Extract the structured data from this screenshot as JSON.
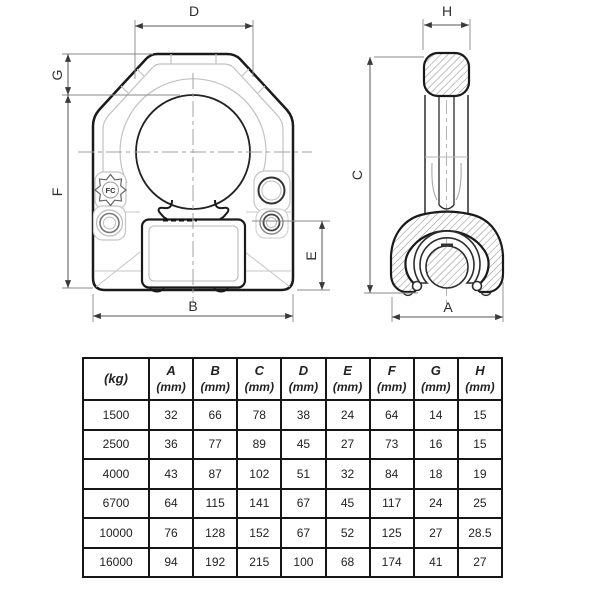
{
  "drawing": {
    "front_view": {
      "dim_labels": {
        "D": "D",
        "G": "G",
        "F": "F",
        "B": "B",
        "E": "E"
      },
      "logo_text": "FC"
    },
    "side_view": {
      "dim_labels": {
        "H": "H",
        "C": "C",
        "A": "A"
      }
    },
    "line_color": "#1a1a1a",
    "hatch_color": "#909090"
  },
  "table": {
    "headers": [
      {
        "line1": "(kg)",
        "line2": ""
      },
      {
        "line1": "A",
        "line2": "(mm)"
      },
      {
        "line1": "B",
        "line2": "(mm)"
      },
      {
        "line1": "C",
        "line2": "(mm)"
      },
      {
        "line1": "D",
        "line2": "(mm)"
      },
      {
        "line1": "E",
        "line2": "(mm)"
      },
      {
        "line1": "F",
        "line2": "(mm)"
      },
      {
        "line1": "G",
        "line2": "(mm)"
      },
      {
        "line1": "H",
        "line2": "(mm)"
      }
    ],
    "rows": [
      [
        "1500",
        "32",
        "66",
        "78",
        "38",
        "24",
        "64",
        "14",
        "15"
      ],
      [
        "2500",
        "36",
        "77",
        "89",
        "45",
        "27",
        "73",
        "16",
        "15"
      ],
      [
        "4000",
        "43",
        "87",
        "102",
        "51",
        "32",
        "84",
        "18",
        "19"
      ],
      [
        "6700",
        "64",
        "115",
        "141",
        "67",
        "45",
        "117",
        "24",
        "25"
      ],
      [
        "10000",
        "76",
        "128",
        "152",
        "67",
        "52",
        "125",
        "27",
        "28.5"
      ],
      [
        "16000",
        "94",
        "192",
        "215",
        "100",
        "68",
        "174",
        "41",
        "27"
      ]
    ]
  }
}
